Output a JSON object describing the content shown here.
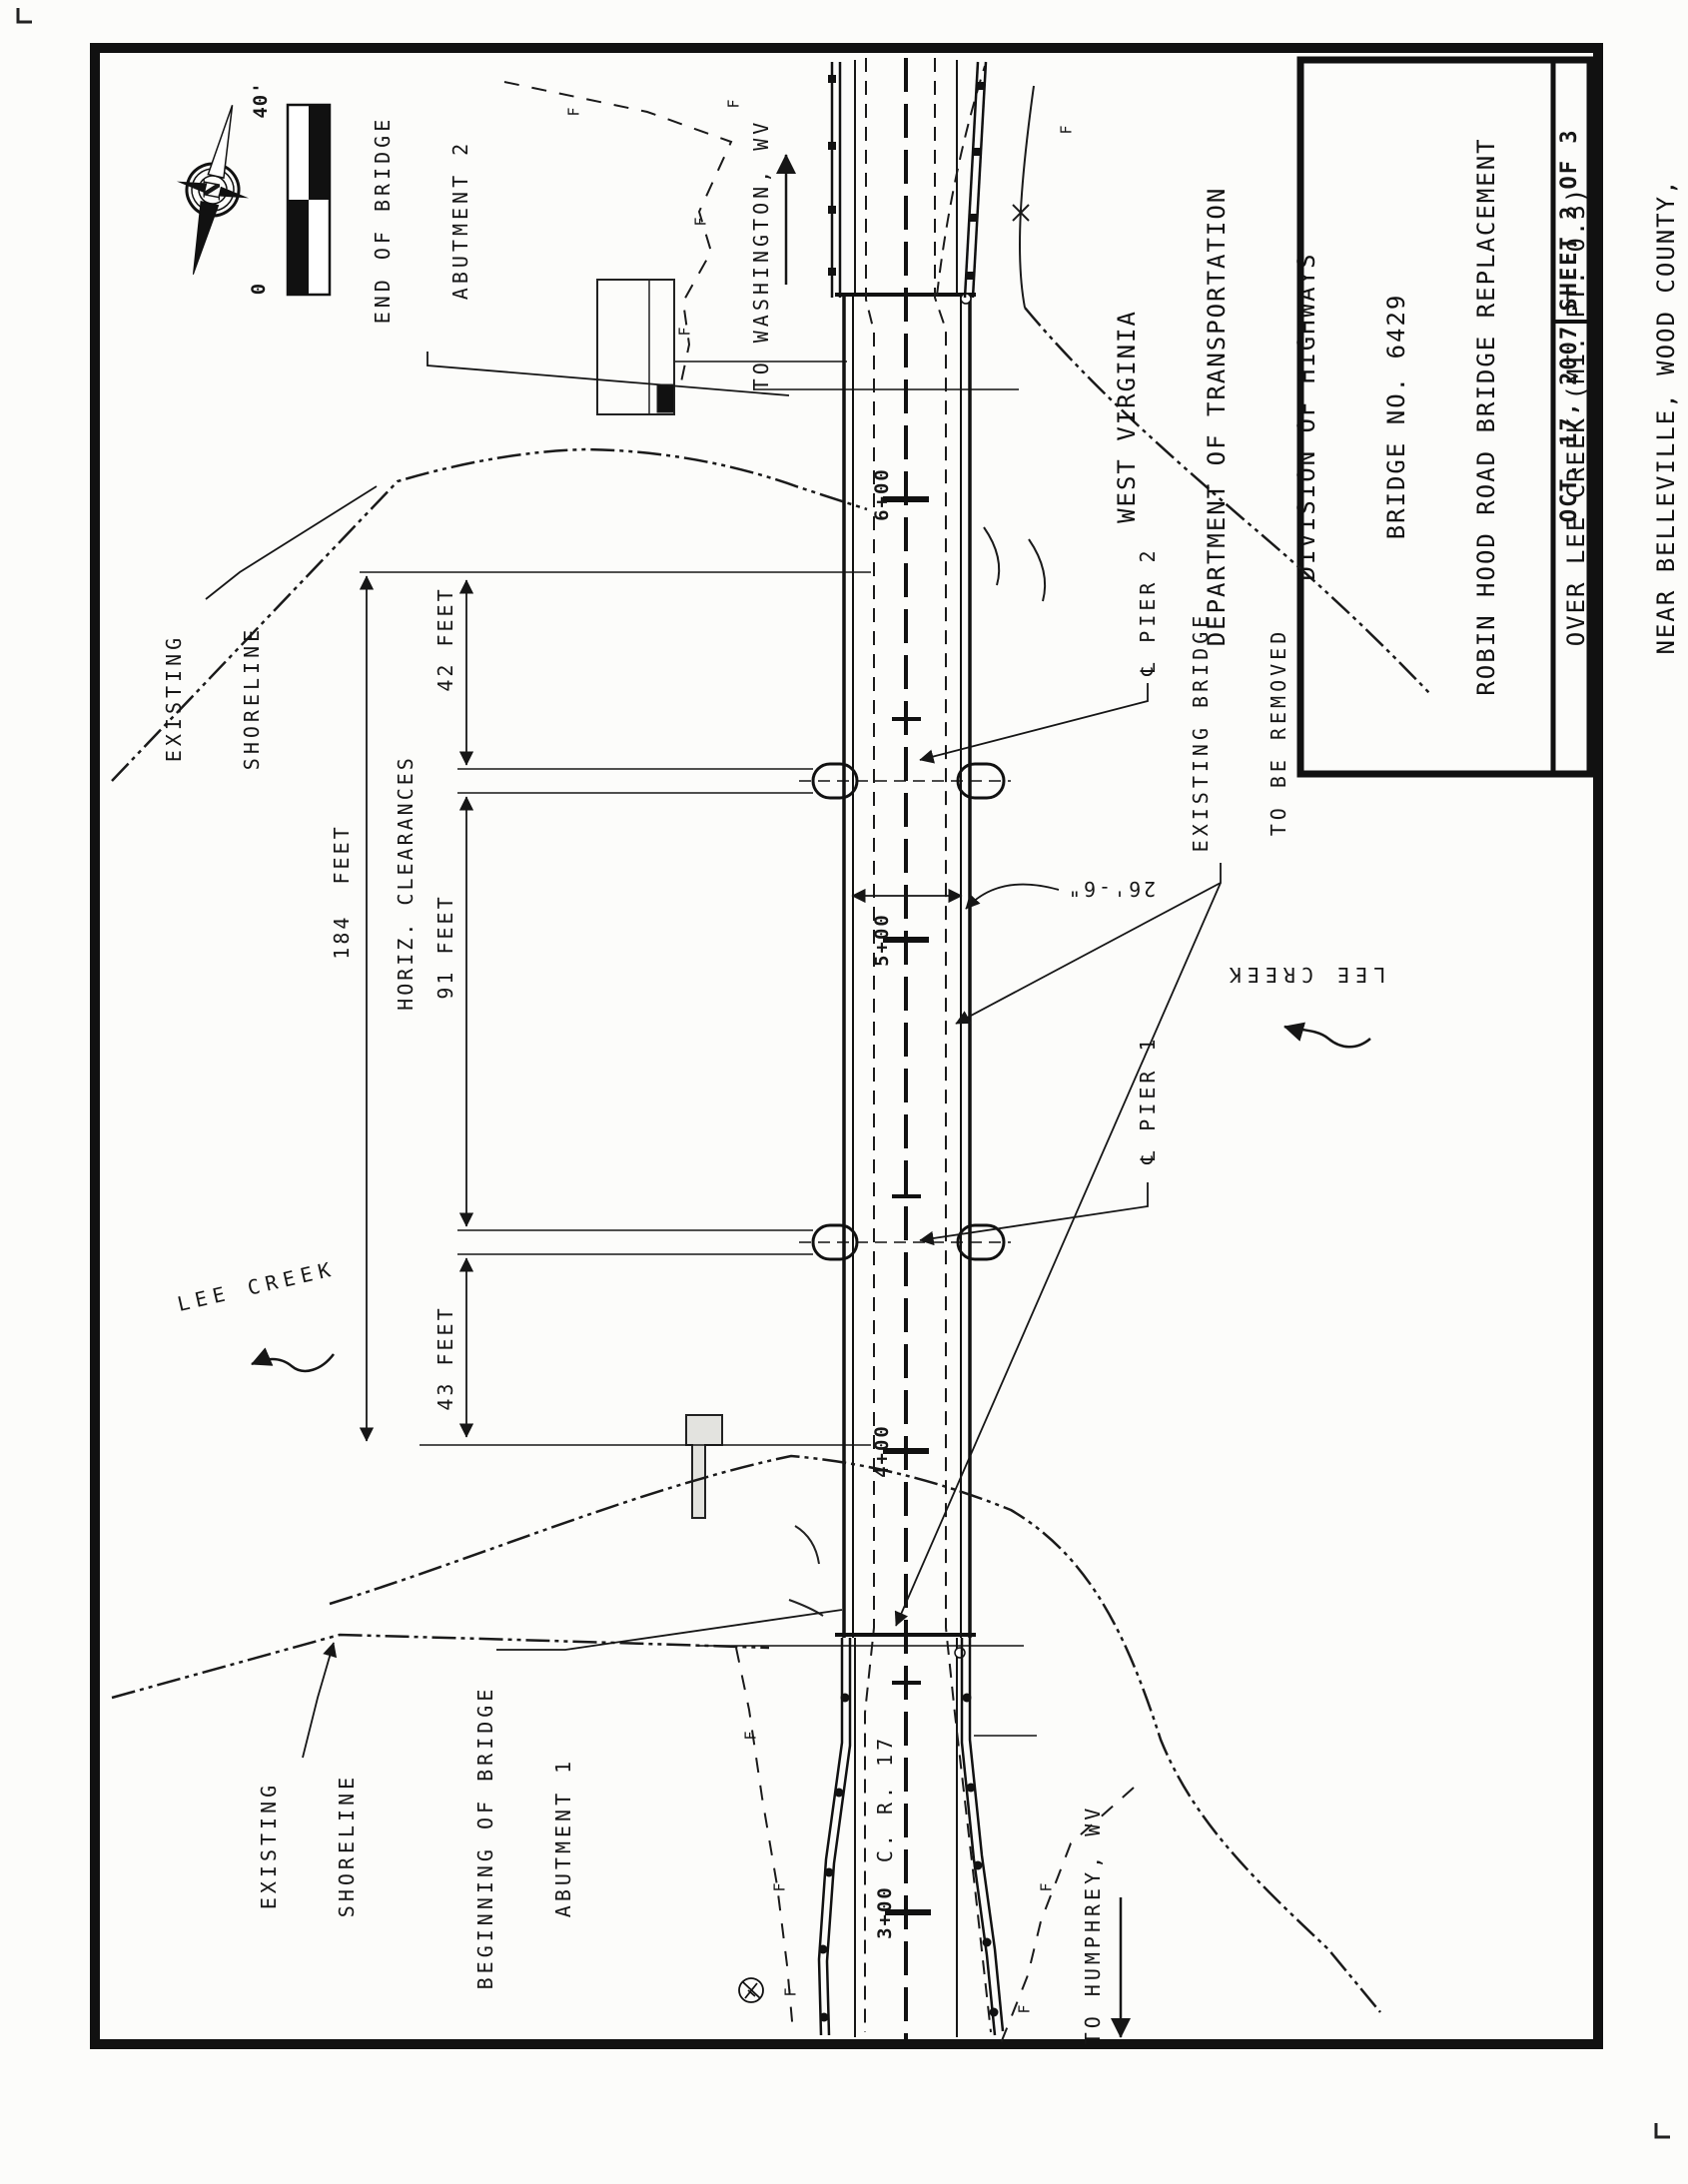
{
  "title_block": {
    "lines": [
      "WEST VIRGINIA",
      "DEPARTMENT OF TRANSPORTATION",
      "DIVISION OF HIGHWAYS",
      "BRIDGE NO. 6429",
      "ROBIN HOOD ROAD BRIDGE REPLACEMENT",
      "OVER LEE CREEK (MI. PT. 0.3)",
      "NEAR BELLEVILLE, WOOD COUNTY,",
      "WEST VIRGINIA"
    ],
    "date": "OCT. 17, 2007",
    "sheet": "SHEET 2 OF 3"
  },
  "labels": {
    "end_of_bridge": [
      "END OF BRIDGE",
      "ABUTMENT 2"
    ],
    "beginning_of_bridge": [
      "BEGINNING OF BRIDGE",
      "ABUTMENT 1"
    ],
    "existing_shoreline_top": [
      "EXISTING",
      "SHORELINE"
    ],
    "existing_shoreline_bottom": [
      "EXISTING",
      "SHORELINE"
    ],
    "existing_bridge": [
      "EXISTING BRIDGE",
      "TO BE REMOVED"
    ],
    "to_washington": "TO WASHINGTON, WV",
    "to_humphrey": "TO HUMPHREY, WV",
    "lee_creek_left": "LEE CREEK",
    "lee_creek_right": "LEE CREEK",
    "pier1": "℄ PIER 1",
    "pier2": "℄ PIER 2",
    "road_name": "C. R. 17"
  },
  "dimensions": {
    "overall": "184  FEET",
    "heading": "HORIZ. CLEARANCES",
    "span_a": "42 FEET",
    "span_b": "91 FEET",
    "span_c": "43 FEET",
    "width": "26'-6\""
  },
  "stations": {
    "s3": "3+00",
    "s4": "4+00",
    "s5": "5+00",
    "s6": "6+00"
  },
  "scale_bar": {
    "max": "40'",
    "min": "0"
  },
  "compass": {
    "letter": "N"
  },
  "symbols": {
    "fence": "F"
  }
}
